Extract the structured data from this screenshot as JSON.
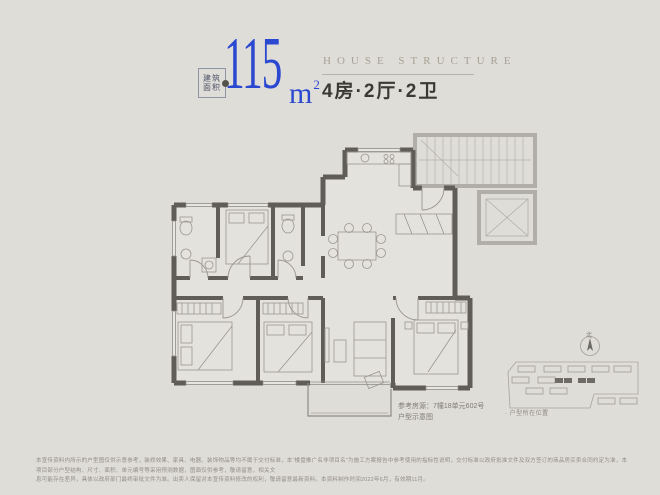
{
  "page": {
    "background": "#dfddd7"
  },
  "header": {
    "area_label_top": "建筑",
    "area_label_bottom": "面积",
    "area_value": "115",
    "area_unit": "m",
    "area_unit_sup": "2",
    "subtitle_en": "HOUSE STRUCTURE",
    "layout_title": "4房·2厅·2卫",
    "accent_blue": "#2b48d1"
  },
  "floorplan": {
    "caption_ref": "参考房源：7幢18单元602号",
    "caption_type": "户型示意图",
    "wall_color": "#605d59",
    "common_wall_color": "#b1aea8",
    "furniture_color": "#9b978f"
  },
  "sitemap": {
    "caption": "· 户型所在位置",
    "north_label": "北",
    "highlight_color": "#6e6b65"
  },
  "footer": {
    "disclaimer_line1": "本宣传资料内所示的户型图仅供示意参考，装修效果、家具、电器、装饰物品等均不属于交付标准，本“楼盘推广名非项目名”为施工方案报告中参考使用的指标性说明，交付标准以政府批准文件及双方签订的商品房买卖合同约定为准，本项目部分户型结构、尺寸、面积、单元编号等采用预测数据，图面仅供参考，敬请留意，相关文",
    "disclaimer_line2": "息可能存在差异，具体以政府部门最终审批文件为准。出卖人保留对本宣传资料修改的权利，敬请留意最新资料。本资料制作时间2022年6月，有效期11月。"
  }
}
